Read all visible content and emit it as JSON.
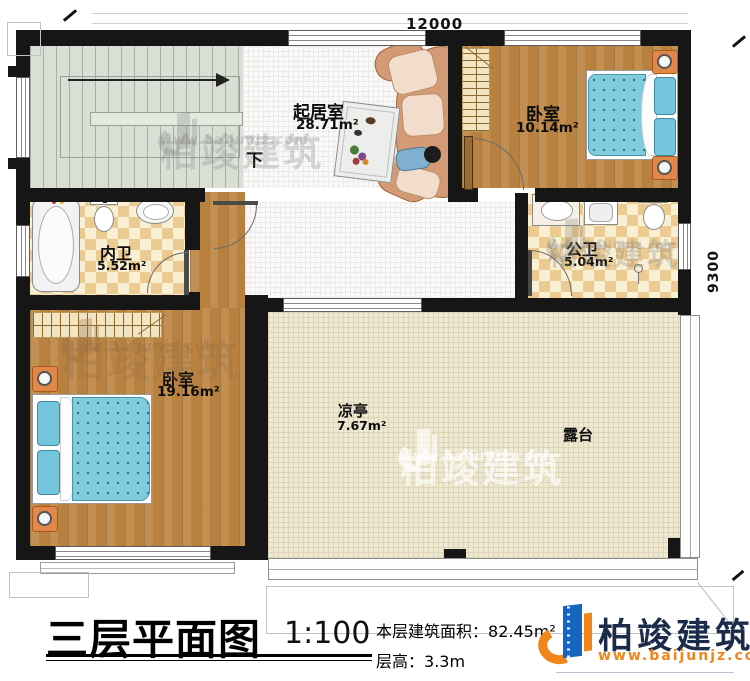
{
  "plan": {
    "dim_top": "12000",
    "dim_right": "9300",
    "stair_label": "下",
    "rooms": [
      {
        "id": "living",
        "name": "起居室",
        "area": "28.71m²"
      },
      {
        "id": "bedroom_top",
        "name": "卧室",
        "area": "10.14m²"
      },
      {
        "id": "bath_private",
        "name": "内卫",
        "area": "5.52m²"
      },
      {
        "id": "bath_public",
        "name": "公卫",
        "area": "5.04m²"
      },
      {
        "id": "bedroom_main",
        "name": "卧室",
        "area": "19.16m²"
      },
      {
        "id": "pavilion",
        "name": "凉亭",
        "area": "7.67m²"
      },
      {
        "id": "terrace",
        "name": "露台",
        "area": ""
      }
    ]
  },
  "title_block": {
    "title": "三层平面图",
    "scale": "1:100",
    "area_label": "本层建筑面积：",
    "area_value": "82.45m²",
    "height_label": "层高：",
    "height_value": "3.3m"
  },
  "brand": {
    "name": "柏竣建筑",
    "url": "www.baijunjz.com"
  },
  "watermark": {
    "text": "柏竣建筑",
    "url": "www.baijunjz.com"
  },
  "colors": {
    "wall": "#161616",
    "wood_floor": "#b9813f",
    "tile_light": "#f9efd2",
    "tile_dark": "#eccb92",
    "terrace": "#efe9d4",
    "stair": "#d9dfd5",
    "bed_blue": "#7fccdf",
    "brand_navy": "#1b2b4a",
    "brand_orange": "#f08519"
  }
}
